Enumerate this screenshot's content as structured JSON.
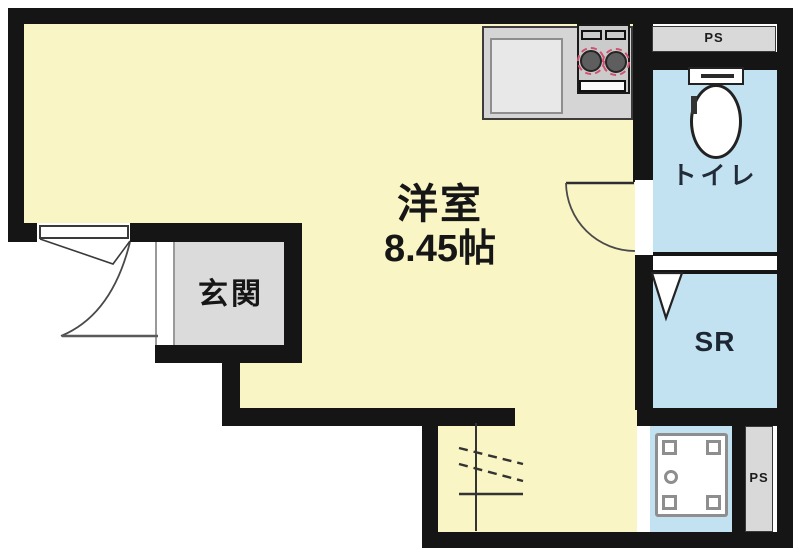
{
  "plan": {
    "rooms": {
      "main_room": {
        "name": "洋室",
        "size": "8.45帖"
      },
      "entrance": {
        "name": "玄関"
      },
      "toilet": {
        "name": "トイレ"
      },
      "service_room": {
        "name": "SR"
      },
      "pipe_space_top": {
        "name": "PS"
      },
      "pipe_space_bottom": {
        "name": "PS"
      }
    },
    "colors": {
      "wall": "#151515",
      "main_room_fill": "#FAF5C4",
      "wet_area_fill": "#C2E2F2",
      "entrance_fill": "#DBDBDB",
      "pipe_space_fill": "#D9D9D9",
      "counter_fill": "#D5D5D5",
      "burner_ring": "#D15070"
    }
  }
}
